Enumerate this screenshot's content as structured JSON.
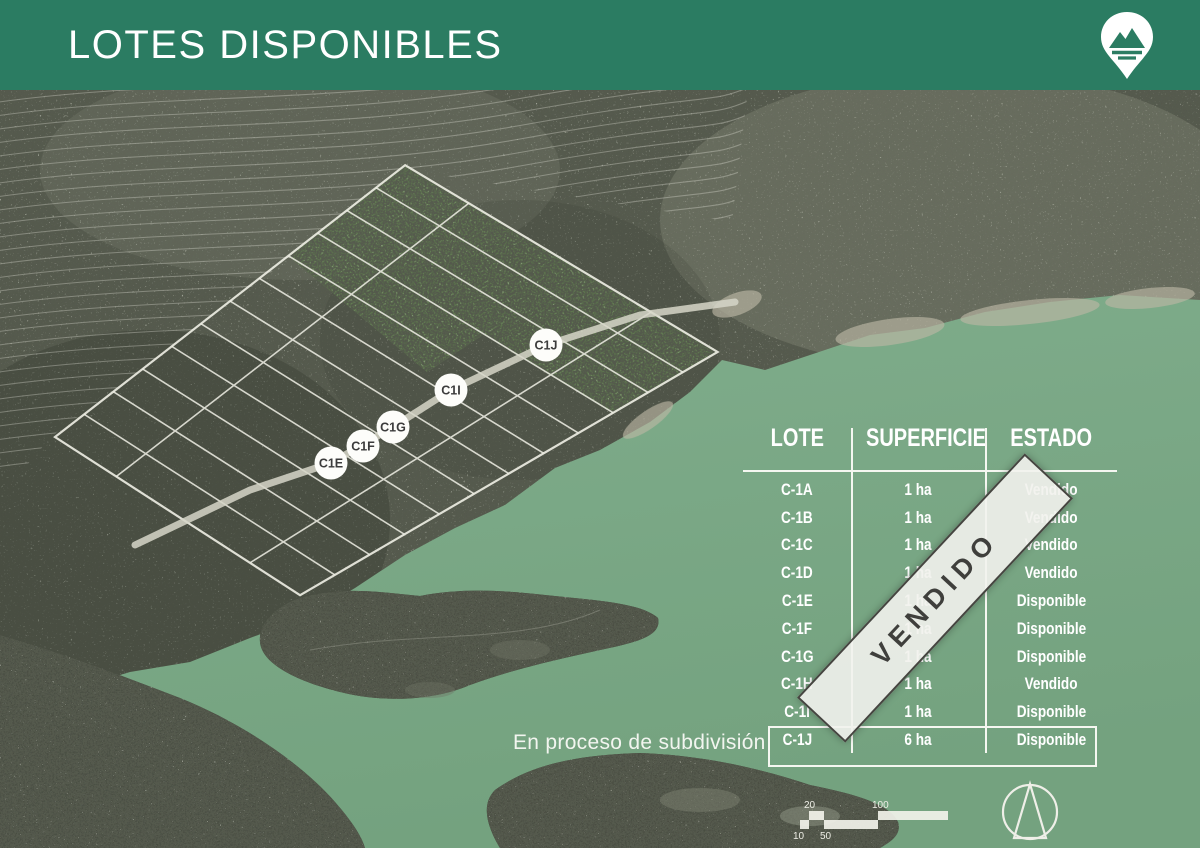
{
  "header": {
    "title": "LOTES DISPONIBLES"
  },
  "colors": {
    "header_green": "#2b7c62",
    "water": "#7ba887",
    "forest": "#5c6052",
    "lot_highlight_green": "#6b9750",
    "table_text": "#ffffff",
    "banner_text": "#3f3f3c"
  },
  "map": {
    "lot_markers": [
      {
        "label": "C1E"
      },
      {
        "label": "C1F"
      },
      {
        "label": "C1G"
      },
      {
        "label": "C1I"
      },
      {
        "label": "C1J"
      }
    ],
    "caption": "En proceso de subdivisión",
    "sold_banner": "VENDIDO",
    "scale_bar": {
      "top_labels": [
        "20",
        "100"
      ],
      "bottom_labels": [
        "10",
        "50"
      ]
    },
    "compass": "north-arrow"
  },
  "table": {
    "columns": [
      "LOTE",
      "SUPERFICIE",
      "ESTADO"
    ],
    "rows": [
      {
        "lote": "C-1A",
        "superficie": "1 ha",
        "estado": "Vendido",
        "highlighted": false
      },
      {
        "lote": "C-1B",
        "superficie": "1 ha",
        "estado": "Vendido",
        "highlighted": false
      },
      {
        "lote": "C-1C",
        "superficie": "1 ha",
        "estado": "Vendido",
        "highlighted": false
      },
      {
        "lote": "C-1D",
        "superficie": "1 ha",
        "estado": "Vendido",
        "highlighted": false
      },
      {
        "lote": "C-1E",
        "superficie": "1 ha",
        "estado": "Disponible",
        "highlighted": false
      },
      {
        "lote": "C-1F",
        "superficie": "1 ha",
        "estado": "Disponible",
        "highlighted": false
      },
      {
        "lote": "C-1G",
        "superficie": "1 ha",
        "estado": "Disponible",
        "highlighted": false
      },
      {
        "lote": "C-1H",
        "superficie": "1 ha",
        "estado": "Vendido",
        "highlighted": false
      },
      {
        "lote": "C-1I",
        "superficie": "1 ha",
        "estado": "Disponible",
        "highlighted": false
      },
      {
        "lote": "C-1J",
        "superficie": "6 ha",
        "estado": "Disponible",
        "highlighted": true
      }
    ]
  }
}
